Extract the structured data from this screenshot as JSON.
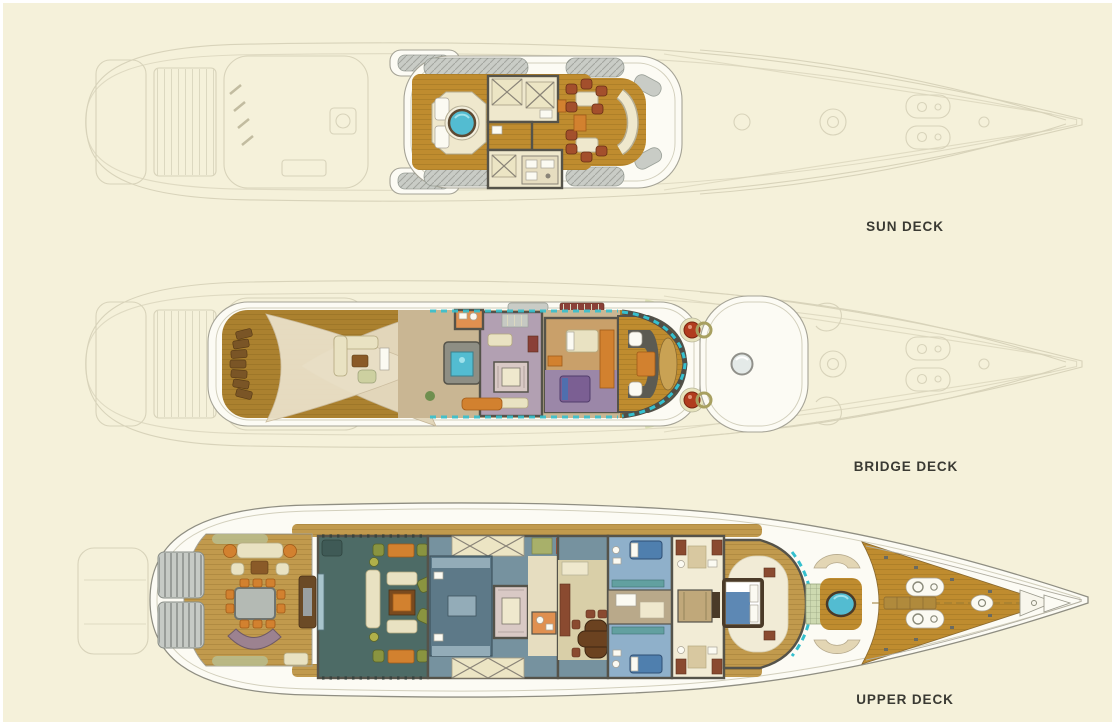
{
  "page_title": "Yacht deck plans",
  "decks": [
    {
      "id": "sun-deck",
      "label": "SUN DECK",
      "features": [
        "jacuzzi",
        "sun-pads",
        "wet-bar",
        "skylights",
        "alfresco-dining",
        "observation-settee"
      ]
    },
    {
      "id": "bridge-deck",
      "label": "BRIDGE DECK",
      "features": [
        "sun-loungers",
        "shade-sails",
        "lounge-seating",
        "spa-tub",
        "sky-lounge",
        "stairs",
        "captain-cabin",
        "wheelhouse",
        "helm-chairs",
        "compass-domes",
        "roof-hatch"
      ]
    },
    {
      "id": "upper-deck",
      "label": "UPPER DECK",
      "features": [
        "stern-stairs",
        "aft-deck-lounge",
        "alfresco-dining-table",
        "main-salon",
        "galley",
        "staircase",
        "dining-room",
        "guest-cabins",
        "master-bathrooms",
        "master-suite",
        "spa-pool",
        "curved-settees",
        "foredeck",
        "capstans",
        "bow-platform"
      ]
    }
  ],
  "colors": {
    "background": "#f5f1da",
    "label_text": "#3a3a33",
    "ghost_line": "#d8d3ba",
    "hull_white": "#fcfbf4",
    "wall": "#55534a",
    "teak": "#bf8c2f",
    "teak_light": "#c19a4d",
    "bridge_teak": "#ab812f",
    "cream_room": "#efe8cd",
    "skylight": "#ece5c4",
    "jacuzzi": "#53bcd1",
    "window_teal": "#35c0ce",
    "salon_floor": "#4d6b66",
    "galley_floor": "#76929f",
    "cabin_blue": "#8fb0ca",
    "bed_blue": "#4f7fae",
    "lounge_purple": "#b2a0b2",
    "bed_purple": "#7b5f93",
    "orange": "#d2812f",
    "red_chair": "#a34f2c",
    "olive": "#8a9440",
    "sail_cream": "#e9dfc6",
    "stair_gray": "#c6cac5",
    "mauve_stair": "#9c8290",
    "green_trim": "#dde0b4",
    "compass_red": "#b13c1e",
    "dining_beige": "#d9cfa8"
  }
}
